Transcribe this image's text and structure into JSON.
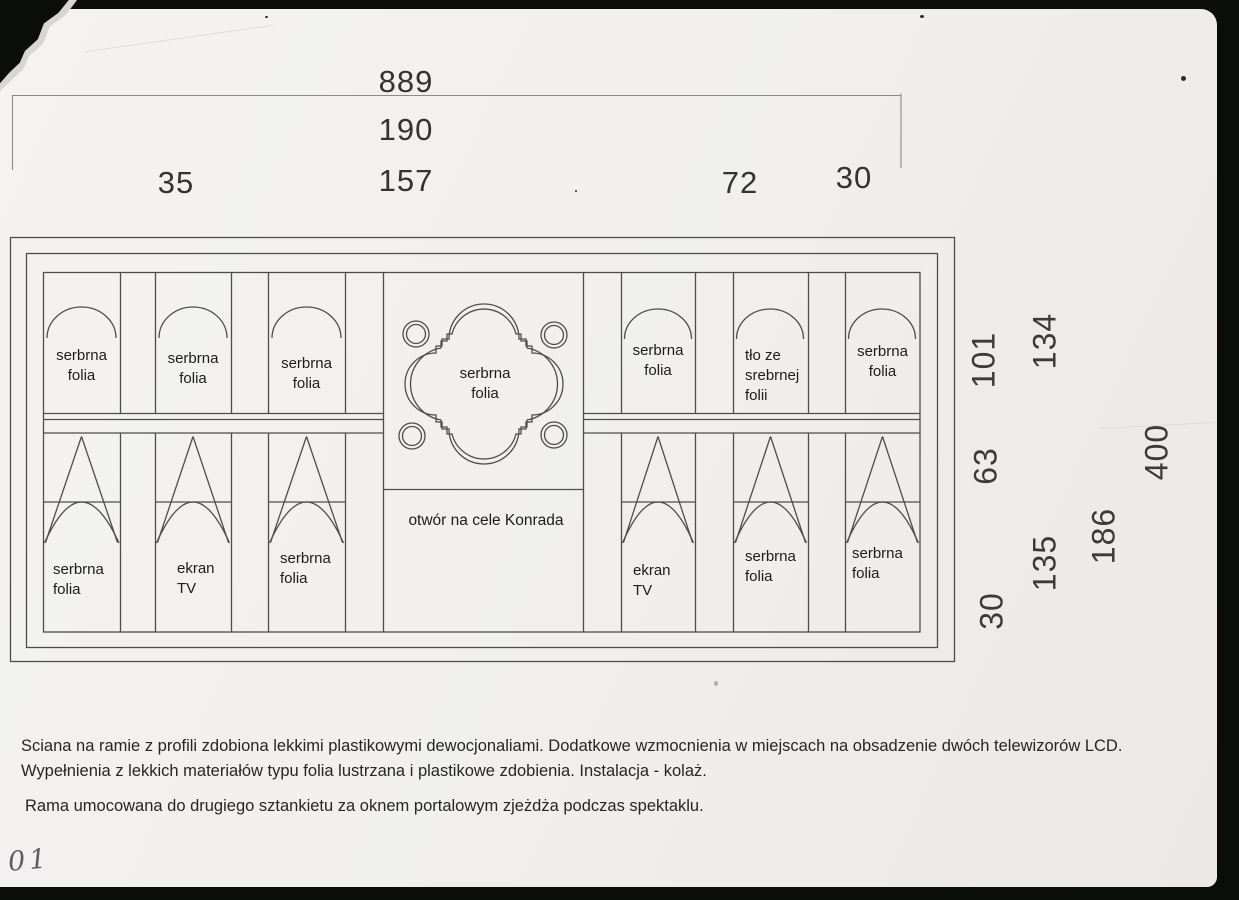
{
  "dims_top": [
    "889",
    "190",
    "157",
    "35",
    "72",
    "30"
  ],
  "dims_right": [
    "101",
    "134",
    "63",
    "400",
    "135",
    "186",
    "30"
  ],
  "panels_upper": [
    "serbrna\nfolia",
    "serbrna\nfolia",
    "serbrna\nfolia",
    "serbrna\nfolia",
    "serbrna\nfolia",
    "tło ze\nsrebrnej\nfolii",
    "serbrna\nfolia"
  ],
  "panels_lower": [
    "serbrna\nfolia",
    "ekran\nTV",
    "serbrna\nfolia",
    "ekran\nTV",
    "serbrna\nfolia",
    "serbrna\nfolia"
  ],
  "opening_label": "otwór na cele Konrada",
  "notes": [
    "Sciana na ramie z profili zdobiona lekkimi plastikowymi dewocjonaliami. Dodatkowe wzmocnienia w miejscach na obsadzenie dwóch telewizorów LCD.",
    "Wypełnienia z lekkich materiałów typu folia lustrzana i plastikowe zdobienia. Instalacja - kolaż.",
    "Rama umocowana do drugiego sztankietu za oknem portalowym zjeżdża podczas spektaklu."
  ],
  "handwritten_page_number": "01",
  "colors": {
    "paper": "#f1f0ee",
    "ink": "#2a2a2a",
    "line": "#4d4d4d",
    "background": "#0b0d0b"
  }
}
